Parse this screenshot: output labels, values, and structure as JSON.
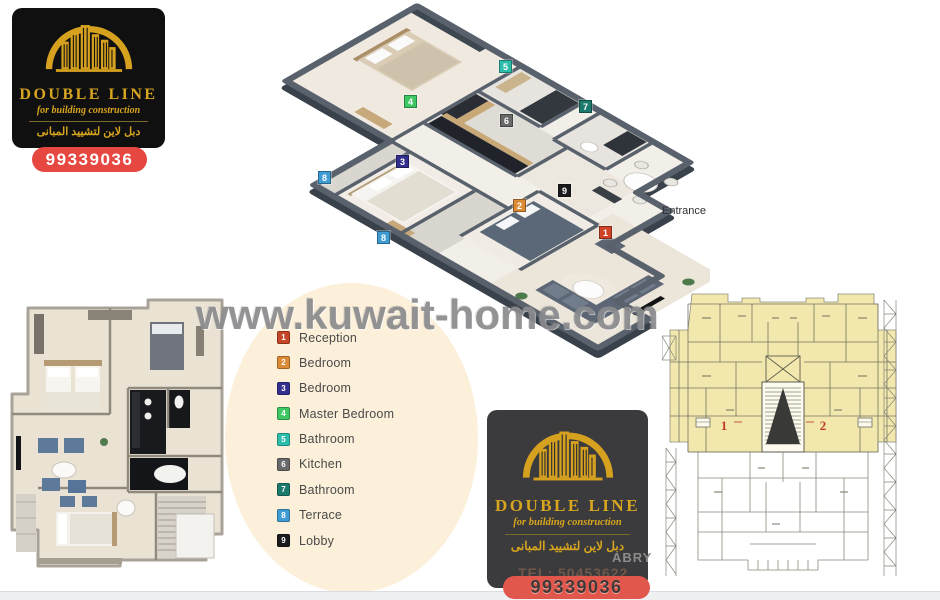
{
  "brand": {
    "name": "DOUBLE LINE",
    "tagline": "for building construction",
    "name_arabic": "دبل لاين لتشييد المبانى",
    "phone": "99339036",
    "gold": "#d8a51f",
    "card_black": "#101010",
    "card_gray": "#3b3b3d",
    "pill_red": "#e64740",
    "pill_red_bottom": "#e2574b"
  },
  "watermark": {
    "site": "www.kuwait-home.com",
    "designer_fragment": "ABRY",
    "designer_tel_fragment": "TEL: 50453622"
  },
  "plan3d": {
    "entrance_label": "Entrance",
    "markers": [
      {
        "num": "1",
        "room": "Reception",
        "color": "#d04327",
        "x": 599,
        "y": 226
      },
      {
        "num": "2",
        "room": "Bedroom",
        "color": "#db8a35",
        "x": 513,
        "y": 199
      },
      {
        "num": "3",
        "room": "Bedroom",
        "color": "#332f8e",
        "x": 396,
        "y": 155
      },
      {
        "num": "4",
        "room": "Master Bedroom",
        "color": "#3fc763",
        "x": 404,
        "y": 95
      },
      {
        "num": "5",
        "room": "Bathroom",
        "color": "#2dbdab",
        "x": 499,
        "y": 60
      },
      {
        "num": "6",
        "room": "Kitchen",
        "color": "#696969",
        "x": 500,
        "y": 114
      },
      {
        "num": "7",
        "room": "Bathroom",
        "color": "#1b7a6d",
        "x": 579,
        "y": 100
      },
      {
        "num": "8",
        "room": "Terrace",
        "color": "#3f9dd4",
        "x": 318,
        "y": 171
      },
      {
        "num": "8",
        "room": "Terrace",
        "color": "#3f9dd4",
        "x": 377,
        "y": 231
      },
      {
        "num": "9",
        "room": "Lobby",
        "color": "#1b1b1d",
        "x": 558,
        "y": 184
      }
    ]
  },
  "legend": {
    "items": [
      {
        "num": "1",
        "label": "Reception",
        "color": "#c44527"
      },
      {
        "num": "2",
        "label": "Bedroom",
        "color": "#db8a35"
      },
      {
        "num": "3",
        "label": "Bedroom",
        "color": "#332f8e"
      },
      {
        "num": "4",
        "label": "Master Bedroom",
        "color": "#3fc763"
      },
      {
        "num": "5",
        "label": "Bathroom",
        "color": "#2dbdab"
      },
      {
        "num": "6",
        "label": "Kitchen",
        "color": "#696969"
      },
      {
        "num": "7",
        "label": "Bathroom",
        "color": "#1b7a6d"
      },
      {
        "num": "8",
        "label": "Terrace",
        "color": "#3f9dd4"
      },
      {
        "num": "9",
        "label": "Lobby",
        "color": "#1b1b1d"
      }
    ]
  },
  "cad": {
    "units": [
      "1",
      "2"
    ],
    "unit_color": "#c23b2a",
    "highlight_color": "#f2e8ad"
  }
}
